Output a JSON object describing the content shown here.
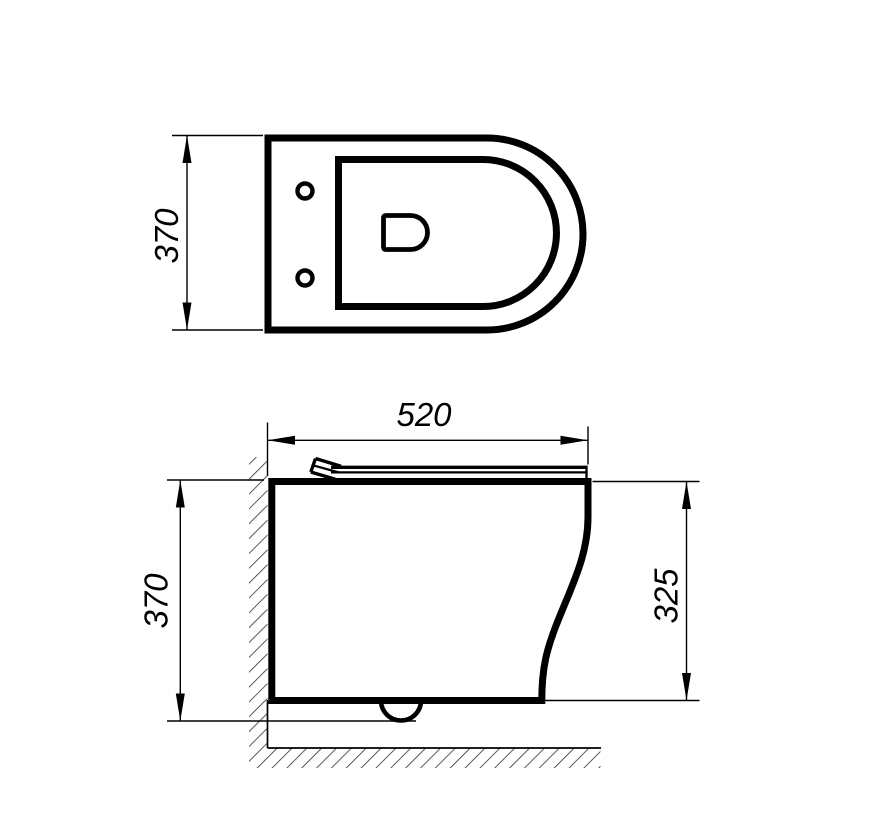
{
  "dimensions": {
    "top_view_width": "370",
    "side_view_depth": "520",
    "side_view_height_overall": "370",
    "side_view_height_rim": "325"
  },
  "colors": {
    "background": "#ffffff",
    "line": "#000000",
    "hatch": "#3c3c3c"
  }
}
